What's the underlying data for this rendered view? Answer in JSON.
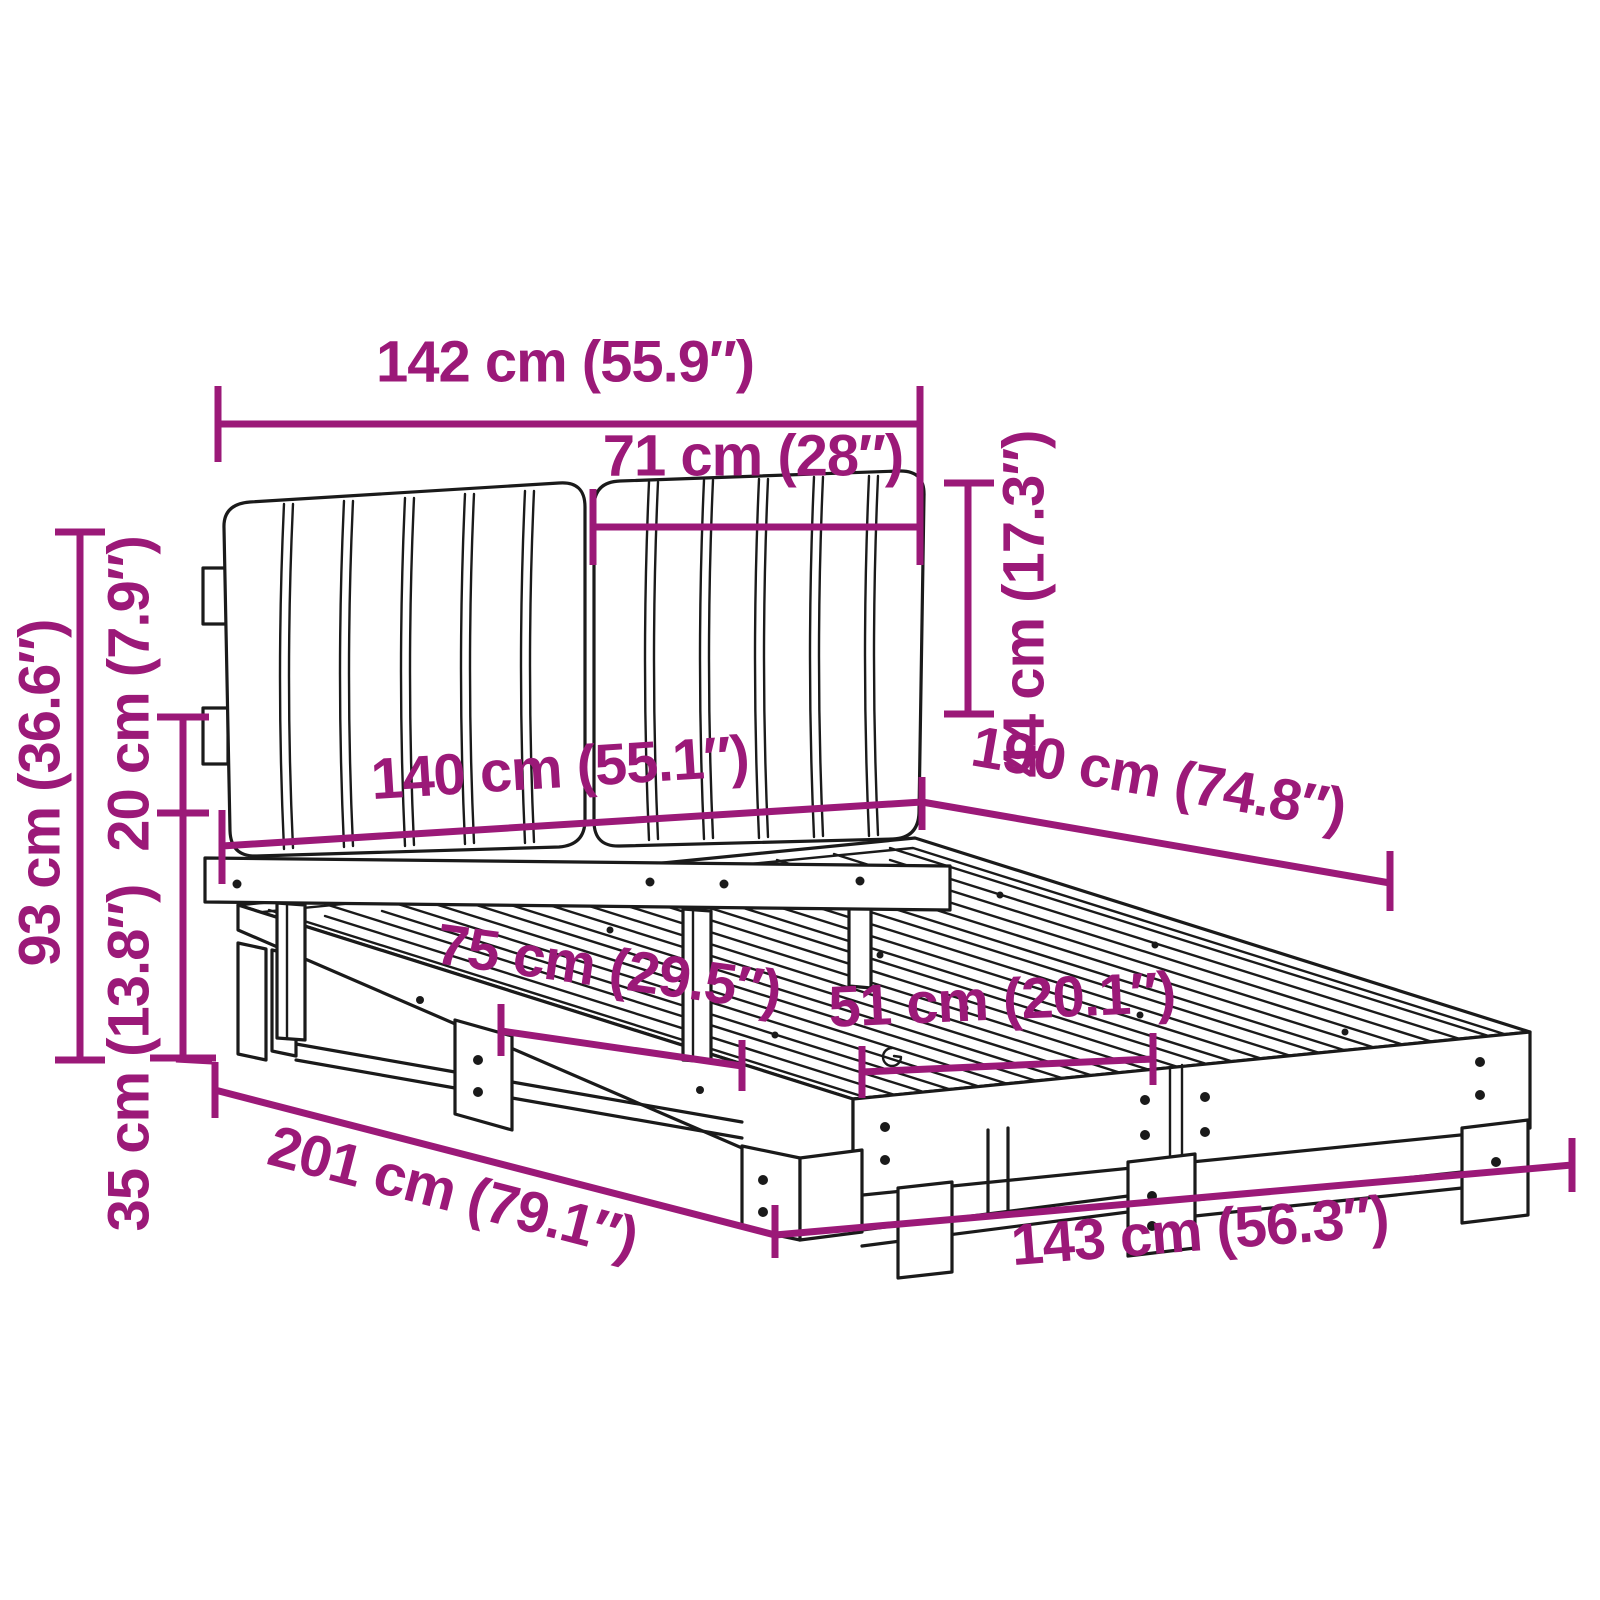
{
  "page": {
    "title": "Bed frame with headboard cushions - dimension diagram"
  },
  "diagram": {
    "accent_color": "#9B1978",
    "line_color": "#1A1A1A",
    "background": "#FFFFFF",
    "dims": {
      "headboard_width": {
        "label": "142 cm (55.9″)"
      },
      "cushion_width": {
        "label": "71 cm (28″)"
      },
      "cushion_height": {
        "label": "44 cm (17.3″)"
      },
      "headboard_height": {
        "label": "93 cm (36.6″)"
      },
      "rail_gap_height": {
        "label": "20 cm (7.9″)"
      },
      "frame_height": {
        "label": "35 cm (13.8″)"
      },
      "bed_width": {
        "label": "140 cm (55.1″)"
      },
      "bed_length": {
        "label": "190 cm (74.8″)"
      },
      "leg_spacing_side": {
        "label": "75 cm (29.5″)"
      },
      "leg_spacing_front": {
        "label": "51 cm (20.1″)"
      },
      "total_length": {
        "label": "201 cm (79.1″)"
      },
      "total_width": {
        "label": "143 cm (56.3″)"
      }
    }
  }
}
